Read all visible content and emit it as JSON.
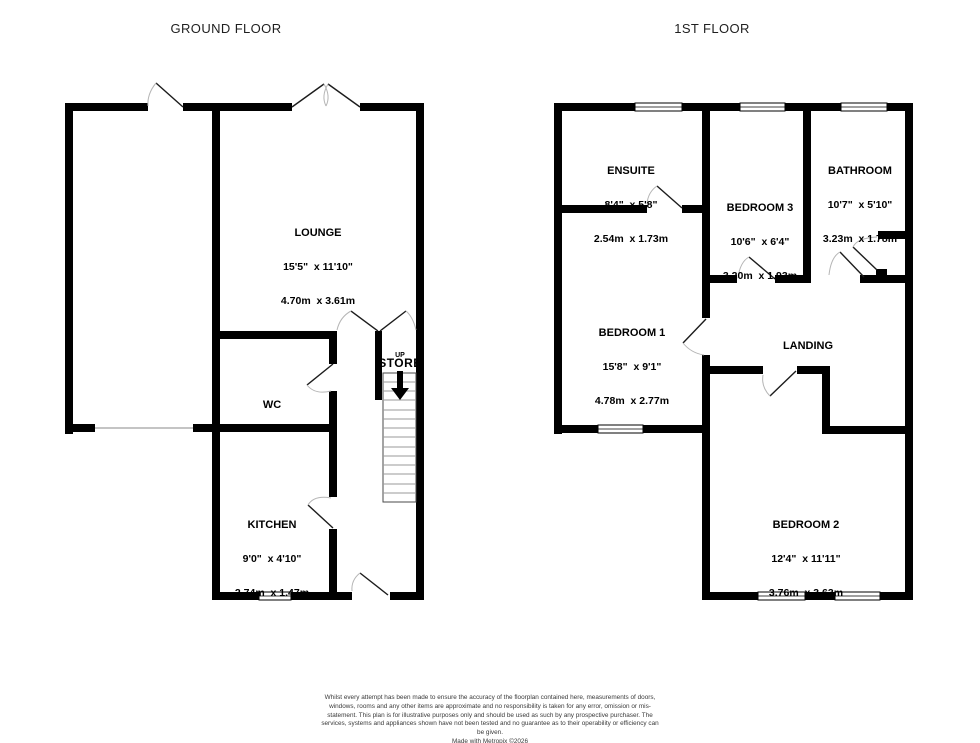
{
  "ground_floor": {
    "title": "GROUND FLOOR",
    "rooms": {
      "lounge": {
        "name": "LOUNGE",
        "imperial": "15'5\"  x 11'10\"",
        "metric": "4.70m  x 3.61m"
      },
      "wc": {
        "name": "WC"
      },
      "store": {
        "name": "STORE",
        "direction": "UP"
      },
      "kitchen": {
        "name": "KITCHEN",
        "imperial": "9'0\"  x 4'10\"",
        "metric": "2.74m  x 1.47m"
      }
    }
  },
  "first_floor": {
    "title": "1ST FLOOR",
    "rooms": {
      "ensuite": {
        "name": "ENSUITE",
        "imperial": "8'4\"  x 5'8\"",
        "metric": "2.54m  x 1.73m"
      },
      "bedroom3": {
        "name": "BEDROOM 3",
        "imperial": "10'6\"  x 6'4\"",
        "metric": "3.20m  x 1.93m"
      },
      "bathroom": {
        "name": "BATHROOM",
        "imperial": "10'7\"  x 5'10\"",
        "metric": "3.23m  x 1.78m"
      },
      "bedroom1": {
        "name": "BEDROOM 1",
        "imperial": "15'8\"  x 9'1\"",
        "metric": "4.78m  x 2.77m"
      },
      "landing": {
        "name": "LANDING"
      },
      "bedroom2": {
        "name": "BEDROOM 2",
        "imperial": "12'4\"  x 11'11\"",
        "metric": "3.76m  x 3.63m"
      }
    }
  },
  "colors": {
    "wall": "#000000",
    "door_arc": "#b5b5b5",
    "stair_tread": "#999999"
  },
  "footer": {
    "disclaimer": "Whilst every attempt has been made to ensure the accuracy of the floorplan contained here, measurements of doors, windows, rooms and any other items are approximate and no responsibility is taken for any error, omission or mis-statement. This plan is for illustrative purposes only and should be used as such by any prospective purchaser. The services, systems and appliances shown have not been tested and no guarantee as to their operability or efficiency can be given.",
    "credit": "Made with Metropix ©2026"
  }
}
